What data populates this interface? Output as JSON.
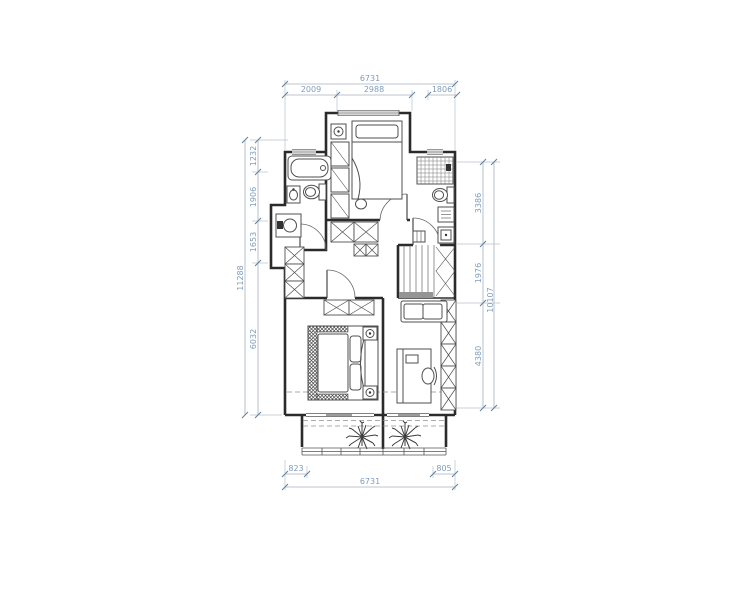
{
  "title": "residential-floor-plan",
  "colors": {
    "wall": "#2b2b2b",
    "furniture": "#4f4f4f",
    "dimension_line": "#a6b2bc",
    "dimension_text": "#7f9db9",
    "background": "#ffffff"
  },
  "dimensions": {
    "top": {
      "total": "6731",
      "seg1": "2009",
      "seg2": "2988",
      "seg3": "1806"
    },
    "bottom": {
      "seg_left": "823",
      "seg_right": "805",
      "total": "6731"
    },
    "left": {
      "total": "11288",
      "seg1": "1232",
      "seg2": "1906",
      "seg3": "1653",
      "seg4": "6032"
    },
    "right": {
      "seg1": "3386",
      "seg2": "1976",
      "seg3": "4380",
      "total": "10107"
    }
  },
  "symbols": {
    "plant": "plant-icon",
    "stairs": "stairs",
    "bed": "bed",
    "bathtub": "bathtub",
    "toilet": "toilet",
    "shower": "shower",
    "washer": "washing-machine",
    "sink": "sink",
    "wardrobe": "x-box-cabinet",
    "desk": "desk",
    "sofa": "sofa",
    "balcony_window": "window-band"
  }
}
